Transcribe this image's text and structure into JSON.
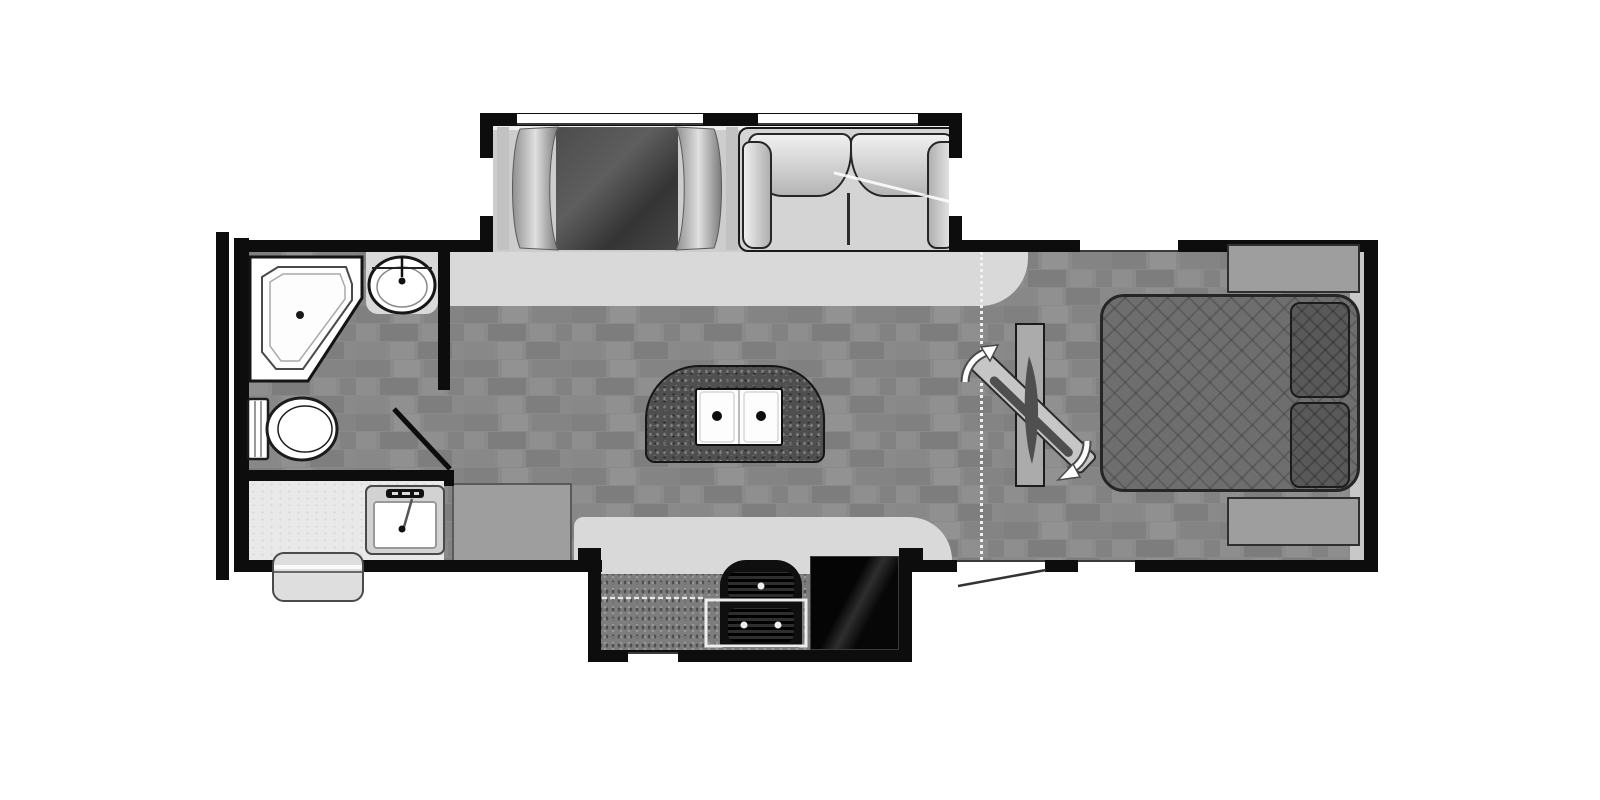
{
  "canvas": {
    "width": 1600,
    "height": 800,
    "background": "#ffffff"
  },
  "palette": {
    "wall": "#0d0d0d",
    "floor_base": "#8a8a8a",
    "floor_tile_dark": "#7d7d7d",
    "floor_tile_light": "#929292",
    "countertop": "#d9d9d9",
    "granite_island": "#4f4f4f",
    "granite_kitchen": "#7d7d7d",
    "appliance_black": "#0f0f0f",
    "upholstery_light": "#d4d4d4",
    "bed": "#6e6e6e",
    "pillow": "#595959",
    "cabinet_gray": "#9e9e9e",
    "fixture_white": "#ffffff"
  },
  "fixtures": {
    "slide_top": "dinette and sofa slide-out",
    "slide_bottom": "kitchen slide-out",
    "dinette": "booth dinette",
    "dinette_table": "dinette table",
    "sofa": "sofa",
    "shower": "corner shower",
    "vanity_sink": "bathroom vanity sink",
    "toilet": "toilet",
    "bath_door": "bathroom door",
    "kitchen_sink": "kitchen sink",
    "pantry": "pantry cabinet",
    "entry_step": "entry step",
    "island": "kitchen island with double sink",
    "counter_top_wall": "countertop",
    "counter_bottom_wall": "countertop",
    "stove": "range stove",
    "fridge": "refrigerator",
    "entry_door": "entry door",
    "window": "window",
    "curtain": "curtain divider",
    "tv_cabinet": "tv cabinet",
    "tv": "swivel tv",
    "bed": "queen bed",
    "pillow": "pillow",
    "nightstand": "nightstand",
    "front_cap": "front cap wall",
    "floor": "tile floor"
  }
}
